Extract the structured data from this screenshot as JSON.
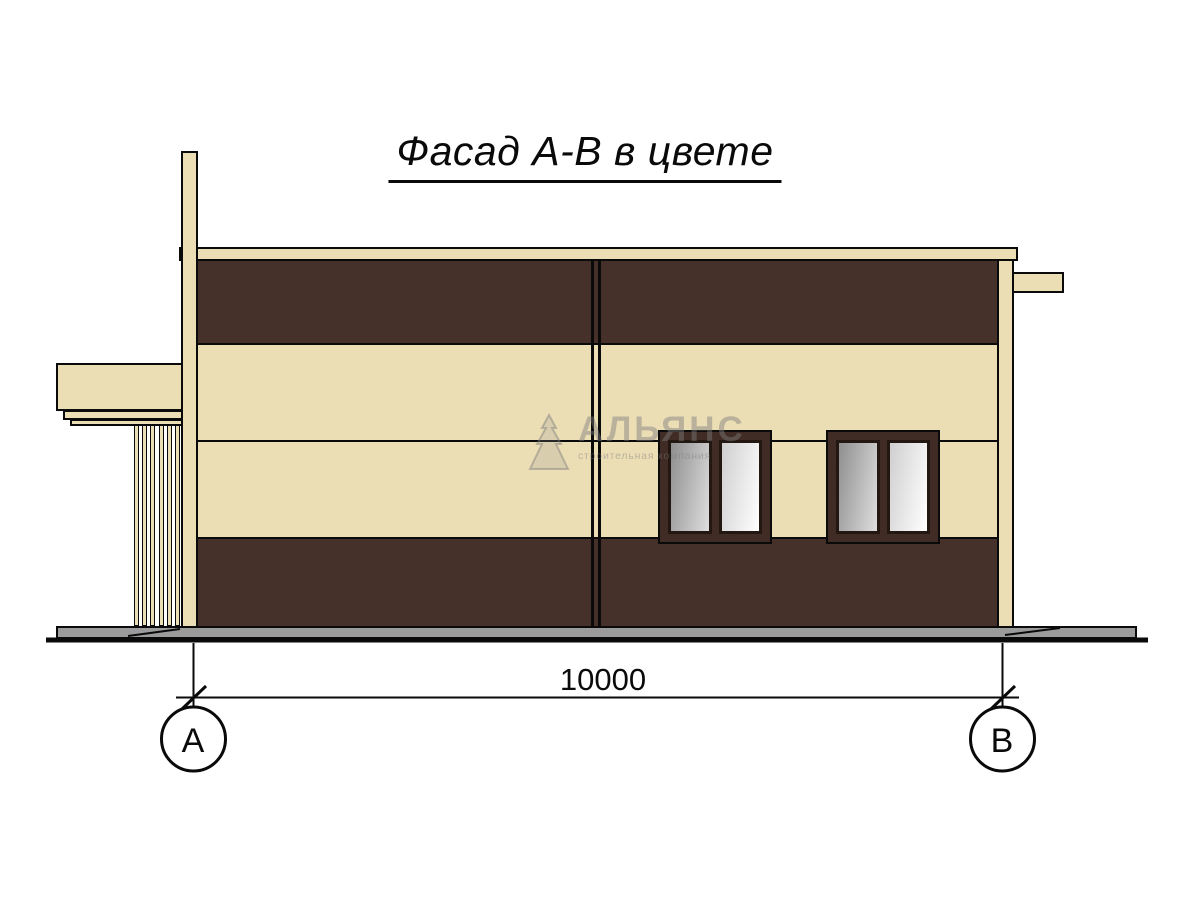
{
  "title": {
    "text": "Фасад А-В в цвете"
  },
  "dimension": {
    "value": "10000"
  },
  "axes": {
    "left": {
      "label": "А"
    },
    "right": {
      "label": "В"
    }
  },
  "watermark": {
    "name": "АЛЬЯНС",
    "tagline": "строительная компания",
    "logo": "stepped-pyramid-icon"
  },
  "colors": {
    "background": "#ffffff",
    "line": "#0a0a0a",
    "cream": "#ebddb4",
    "brown": "#45312a",
    "frame": "#402c25",
    "slab": "#9b9b9b",
    "glass_dark_start": "#8f8f8f",
    "glass_dark_end": "#dedede",
    "glass_light_start": "#cfcfcf",
    "glass_light_end": "#ffffff",
    "watermark": "rgba(125,125,125,0.45)"
  }
}
